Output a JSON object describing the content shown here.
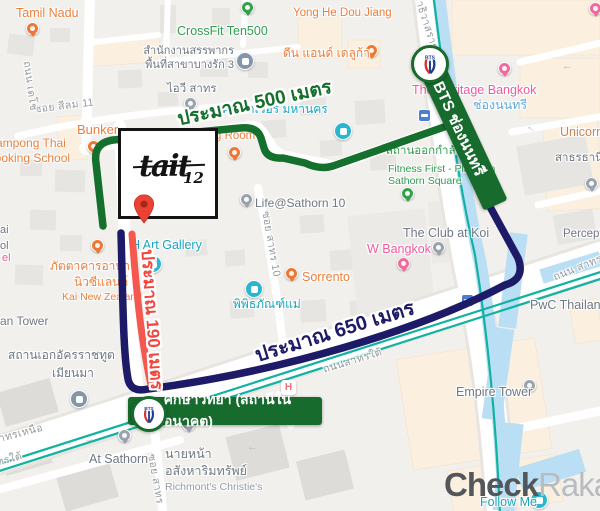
{
  "colors": {
    "banner_green": "#166b2d",
    "route_green": "#15702d",
    "route_navy": "#1d1b67",
    "route_red": "#f4584e",
    "label_red": "#f4453c",
    "watermark_dark": "#52575b",
    "watermark_light": "#b9bcbf",
    "transit_teal": "#12b2a2",
    "water_blue": "#badff5"
  },
  "routes": {
    "green": {
      "label": "ประมาณ 500 เมตร",
      "color": "#15702d"
    },
    "navy": {
      "label": "ประมาณ 650 เมตร",
      "color": "#1d1b67"
    },
    "red": {
      "label": "ประมาณ 190 เมตร",
      "color": "#f4584e"
    }
  },
  "stations": {
    "chong_nonsi": {
      "label": "BTS ช่องนนทรี",
      "logo_text": "BTS"
    },
    "suksawitthaya": {
      "label": "ศึกษาวิทยา (สถานีในอนาคต)",
      "logo_text": "BTS"
    }
  },
  "venue": {
    "name": "tait",
    "number": "12"
  },
  "watermark": {
    "bold": "Check",
    "light": "Raka"
  },
  "icons": {
    "arrow_left": "←",
    "arrow_right": "→",
    "hospital": "H"
  },
  "pois": {
    "tamil_nadu": "Tamil Nadu",
    "crossfit": "CrossFit Ten500",
    "revenue_office_line1": "สำนักงานสรรพากร",
    "revenue_office_line2": "พื้นที่สาขาบางรัก 3",
    "yong_he": "Yong He Dou Jiang",
    "dean_deluca": "ดีน แอนด์ เดลูก้า",
    "ivy_sathorn": "ไอวี สาทร",
    "king_power": "คิงเพาเวอร์ มหานคร",
    "bunker": "Bunker",
    "kampong_line1": "Kampong Thai",
    "kampong_line2": "Cooking School",
    "eating_room_fragment": "g Room",
    "h_art_gallery": "H Art Gallery",
    "nz_line1": "ภัตตาคารอาหาร",
    "nz_line2": "นิวซีแลนด์",
    "nz_line3": "Kai New Zealand",
    "life_sathorn": "Life@Sathorn 10",
    "museum_mae": "พิพิธภัณฑ์แม่",
    "sorrento": "Sorrento",
    "w_bangkok": "W Bangkok",
    "club_koi": "The Club at Koi",
    "heritage": "The Heritage Bangkok",
    "chong_nonsi_station": "ช่องนนทรี",
    "unicorn": "Unicorn",
    "fitness_line1": "สถานออกกำลังกาย",
    "fitness_line2": "Fitness First - Platinum",
    "fitness_line3": "Sathorn Square",
    "perception": "Perception",
    "sathorn_thani": "สาธรธานี",
    "pwc": "PwC Thailand",
    "empire": "Empire Tower",
    "follow_me": "Follow Me",
    "at_sathorn": "At Sathorn",
    "agent_line1": "นายหน้า",
    "agent_line2": "อสังหาริมทรัพย์",
    "agent_line3": "Richmont's Christie's",
    "embassy_line1": "สถานเอกอัครราชทูต",
    "embassy_line2": "เมียนมา",
    "an_tower": "an Tower",
    "frag_ai": "ai",
    "frag_ol": "ol",
    "frag_el": "el"
  },
  "streets": {
    "silom11": "ซอย สีลม 11",
    "decho": "ถนน เดโช",
    "soi_sathorn10": "ซอย สาทร 10",
    "sathorn_tai": "ถนนสาทรใต้",
    "sathorn_nuea": "ถนนสาทรเหนือ",
    "sathorn_tai_left": "ถนนสาทรใต้",
    "soi_sathorn": "ซอย สาทร",
    "narathiwat": "ถนนนราธิวาสราชนครินทร์",
    "thanon_sathorn_right": "ถนน สาทร"
  }
}
